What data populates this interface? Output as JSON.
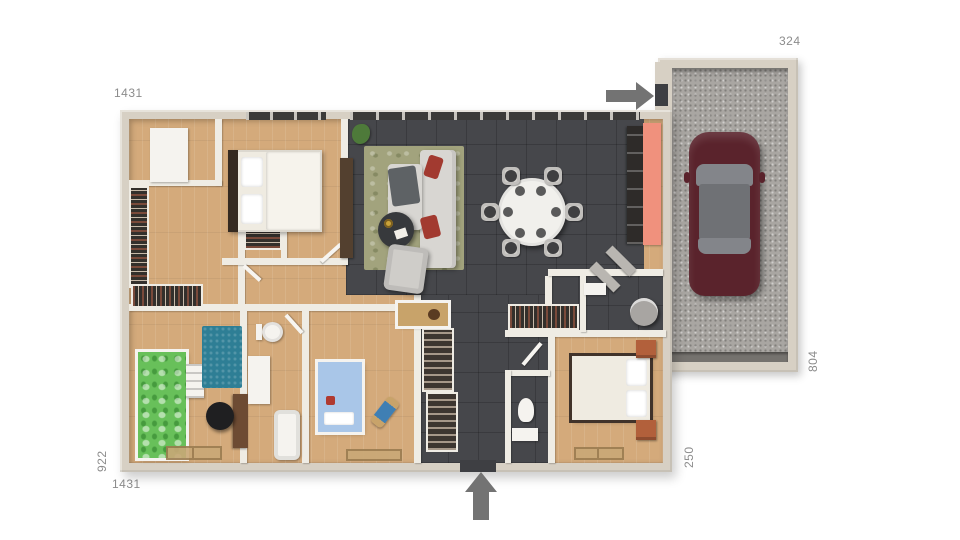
{
  "plan": {
    "dimensions": {
      "top_width": "1431",
      "garage_width": "324",
      "left_depth": "922",
      "bottom_width": "1431",
      "entry_offset": "250",
      "garage_depth": "804"
    },
    "icons": {
      "garage_entry": "arrow-right-icon",
      "main_entrance": "arrow-up-icon"
    },
    "colors": {
      "canvas": "#ffffff",
      "label": "#8c8c8c",
      "arrow": "#737373",
      "wallOuter": "#d7d0c4",
      "wallFace": "#e7e1d6",
      "wallInner": "#efece4",
      "wood": "#d4aa7b",
      "woodLight": "#debb8d",
      "tile": "#46474b",
      "tileDark": "#3e3f43",
      "concrete": "#a9a6a2",
      "garageDoor": "#75726e",
      "carBody": "#5a232c",
      "carGlass": "#83858a",
      "carGlassDark": "#6f7175",
      "salmon": "#f0917d",
      "appliance": "#2e2b29",
      "rugOlive": "#a2a37d",
      "rugTeal": "#2e7e95",
      "sofa": "#d8d6d2",
      "sofaDark": "#5e6265",
      "armchair": "#cfcdc9",
      "pillowRed": "#a23a30",
      "tableDark": "#37393c",
      "dining": "#f1f0ec",
      "chairSeat": "#3f3f41",
      "chairBack": "#d2d0cc",
      "bedWhite": "#efebe1",
      "bedFrame": "#41332a",
      "headboard": "#352a21",
      "bedGreen": "#68c05a",
      "bedBlue": "#a9c6e8",
      "nightstand": "#b2603b",
      "deskWood": "#6d4b33",
      "chairBlack": "#1f1f21",
      "closet": "#33302c",
      "clothes1": "#7a4a3a",
      "clothes2": "#c7b9a8",
      "shoe": "#3d3630",
      "white": "#f5f3ef",
      "matBeige": "#c9a877",
      "matBorder": "#9b7c50",
      "plant": "#4e7a3a",
      "sand": "#c8a36a",
      "windowStrip": "#3c3b39",
      "windowSill": "#c8c5be"
    }
  }
}
